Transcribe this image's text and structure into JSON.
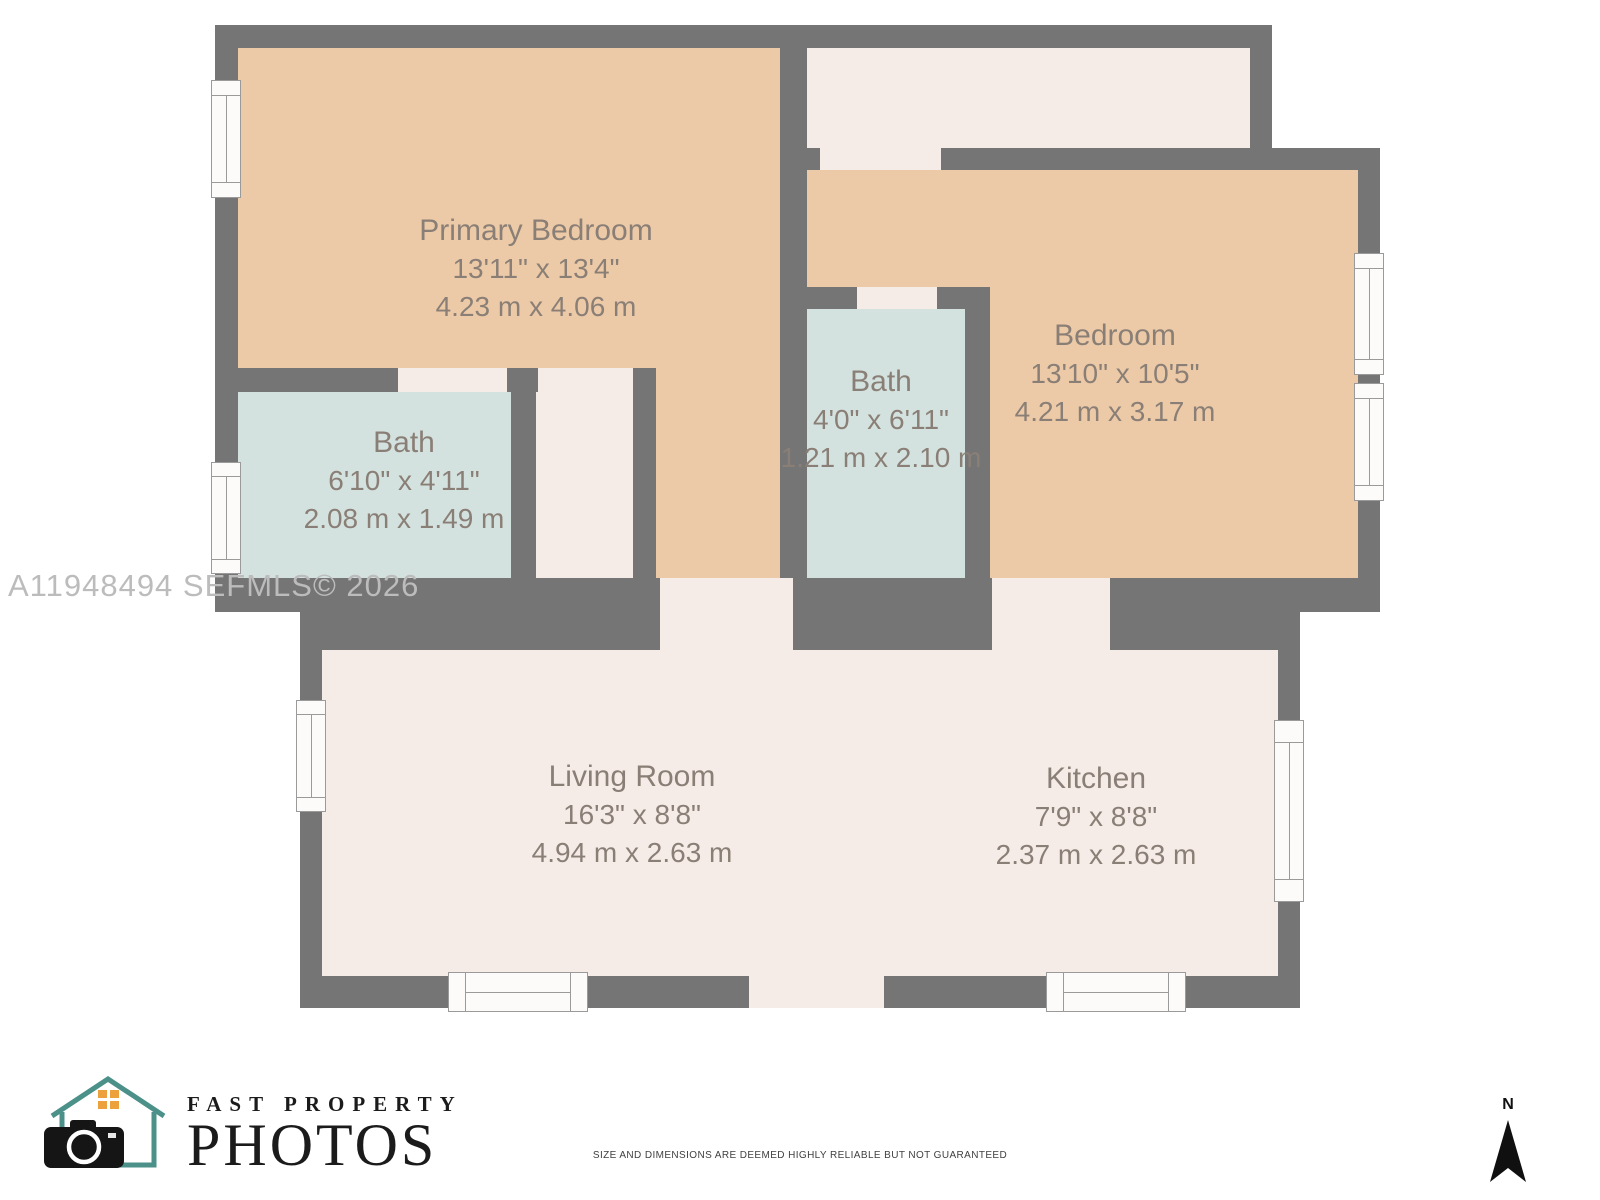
{
  "watermark": "A11948494  SEFMLS© 2026",
  "rooms": {
    "primary_bedroom": {
      "name": "Primary Bedroom",
      "imperial": "13'11\" x 13'4\"",
      "metric": "4.23 m x 4.06 m"
    },
    "bath_left": {
      "name": "Bath",
      "imperial": "6'10\" x 4'11\"",
      "metric": "2.08 m x 1.49 m"
    },
    "bath_center": {
      "name": "Bath",
      "imperial": "4'0\" x 6'11\"",
      "metric": "1.21 m x 2.10 m"
    },
    "bedroom": {
      "name": "Bedroom",
      "imperial": "13'10\" x 10'5\"",
      "metric": "4.21 m x 3.17 m"
    },
    "living_room": {
      "name": "Living Room",
      "imperial": "16'3\" x 8'8\"",
      "metric": "4.94 m x 2.63 m"
    },
    "kitchen": {
      "name": "Kitchen",
      "imperial": "7'9\" x 8'8\"",
      "metric": "2.37 m x 2.63 m"
    }
  },
  "logo": {
    "line1": "FAST PROPERTY",
    "line2": "PHOTOS"
  },
  "compass": {
    "label": "N"
  },
  "disclaimer": "SIZE AND DIMENSIONS ARE DEEMED HIGHLY RELIABLE BUT NOT GUARANTEED",
  "colors": {
    "wall": "#757575",
    "bedroom_fill": "#edcaa7",
    "common_fill": "#f6ece7",
    "bath_fill": "#d4e2df",
    "label_text": "#8a7f76",
    "logo_teal": "#4b9089",
    "logo_orange": "#eda13c"
  }
}
